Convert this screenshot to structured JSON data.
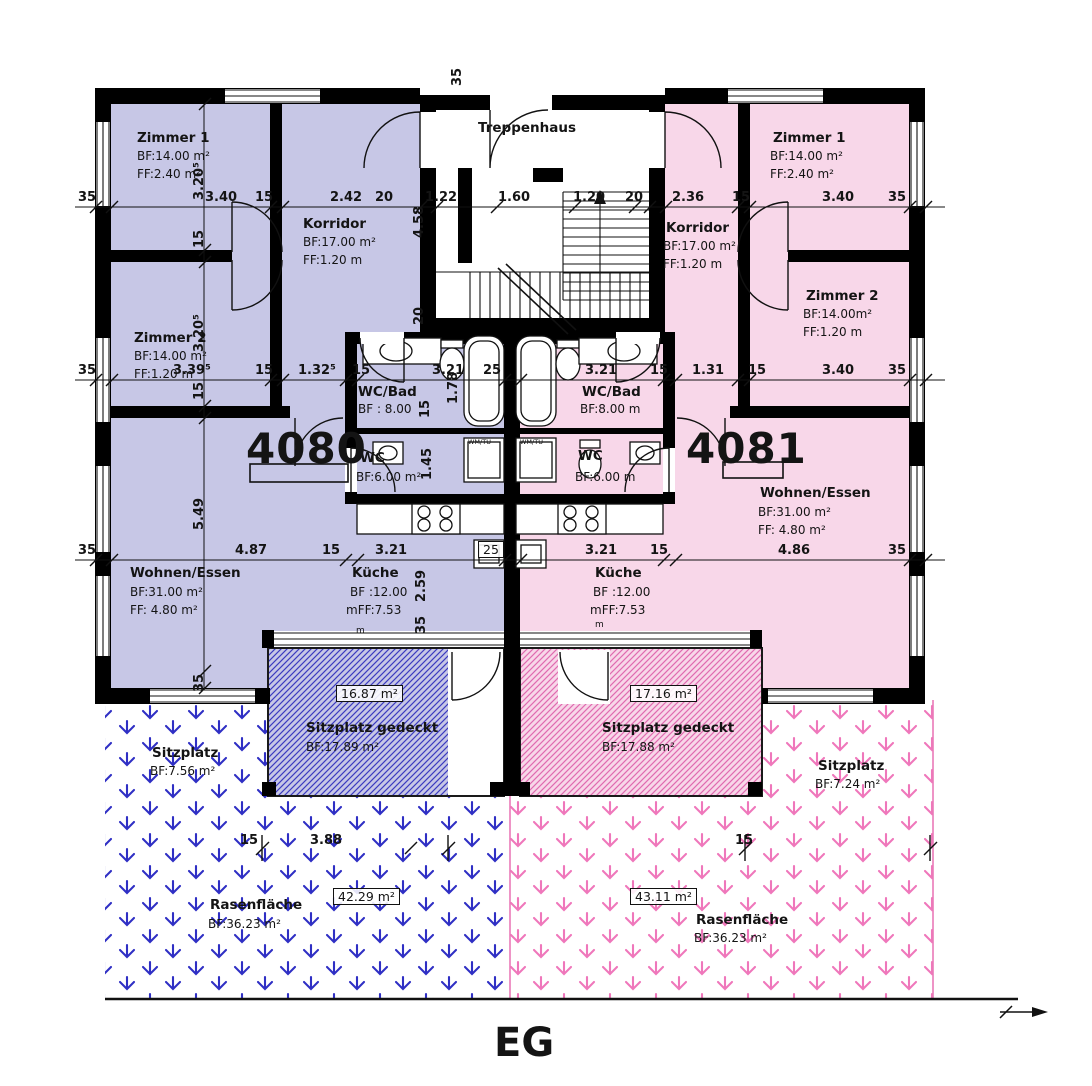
{
  "plan": {
    "level_label": "EG",
    "stairwell_label": "Treppenhaus",
    "appliance_label": "WM/TU",
    "meter_mark": "m"
  },
  "colors": {
    "left_fill": "#c7c7e6",
    "right_fill": "#f8d7e9",
    "left_accent": "#2f2fc4",
    "right_accent": "#ef77bb",
    "wall": "#000000"
  },
  "apartments": {
    "left": {
      "number": "4080",
      "zimmer1_name": "Zimmer 1",
      "zimmer1_bf": "BF:14.00 m²",
      "zimmer1_ff": "FF:2.40 m²",
      "zimmer2_name": "Zimmer 2",
      "zimmer2_bf": "BF:14.00 m²",
      "zimmer2_ff": "FF:1.20 m",
      "korridor_name": "Korridor",
      "korridor_bf": "BF:17.00 m²",
      "korridor_ff": "FF:1.20 m",
      "wcbad_name": "WC/Bad",
      "wcbad_bf": "BF : 8.00",
      "wc_name": "WC",
      "wc_bf": "BF:6.00 m²",
      "kueche_name": "Küche",
      "kueche_bf": "BF :12.00",
      "kueche_ff": "mFF:7.53",
      "wohnen_name": "Wohnen/Essen",
      "wohnen_bf": "BF:31.00 m²",
      "wohnen_ff": "FF: 4.80 m²",
      "terrace_boxed": "16.87 m²",
      "terrace_name": "Sitzplatz gedeckt",
      "terrace_bf": "BF:17.89 m²",
      "sitzplatz_name": "Sitzplatz",
      "sitzplatz_bf": "BF:7.56 m²",
      "rasen_boxed": "42.29 m²",
      "rasen_name": "Rasenfläche",
      "rasen_bf": "BF:36.23 m²"
    },
    "right": {
      "number": "4081",
      "zimmer1_name": "Zimmer 1",
      "zimmer1_bf": "BF:14.00 m²",
      "zimmer1_ff": "FF:2.40 m²",
      "zimmer2_name": "Zimmer 2",
      "zimmer2_bf": "BF:14.00m²",
      "zimmer2_ff": "FF:1.20 m",
      "korridor_name": "Korridor",
      "korridor_bf": "BF:17.00 m²",
      "korridor_ff": "FF:1.20 m",
      "wcbad_name": "WC/Bad",
      "wcbad_bf": "BF:8.00 m",
      "wc_name": "WC",
      "wc_bf": "BF:6.00 m",
      "kueche_name": "Küche",
      "kueche_bf": "BF :12.00",
      "kueche_ff": "mFF:7.53",
      "wohnen_name": "Wohnen/Essen",
      "wohnen_bf": "BF:31.00 m²",
      "wohnen_ff": "FF: 4.80 m²",
      "terrace_boxed": "17.16 m²",
      "terrace_name": "Sitzplatz gedeckt",
      "terrace_bf": "BF:17.88 m²",
      "sitzplatz_name": "Sitzplatz",
      "sitzplatz_bf": "BF:7.24 m²",
      "rasen_boxed": "43.11 m²",
      "rasen_name": "Rasenfläche",
      "rasen_bf": "BF:36.23 m²"
    }
  },
  "dims": {
    "top": [
      "35",
      "3.40",
      "15",
      "2.42",
      "20",
      "1.22",
      "1.60",
      "1.20",
      "20",
      "2.36",
      "15",
      "3.40",
      "35"
    ],
    "mid": [
      "35",
      "3.39⁵",
      "15",
      "1.32⁵",
      "15",
      "3.21",
      "25",
      "3.21",
      "15",
      "1.31",
      "15",
      "3.40",
      "35"
    ],
    "lower": [
      "35",
      "4.87",
      "15",
      "3.21",
      "25",
      "3.21",
      "15",
      "4.86",
      "35"
    ],
    "garden": [
      "15",
      "3.88",
      "15"
    ],
    "vleft": [
      "3.20⁵",
      "15",
      "3.20⁵",
      "15",
      "5.49",
      "35"
    ],
    "vcenter": [
      "35",
      "4.58",
      "20"
    ],
    "vbath": [
      "1.78",
      "15",
      "1.45"
    ],
    "vkueche": [
      "2.59",
      "35"
    ]
  }
}
